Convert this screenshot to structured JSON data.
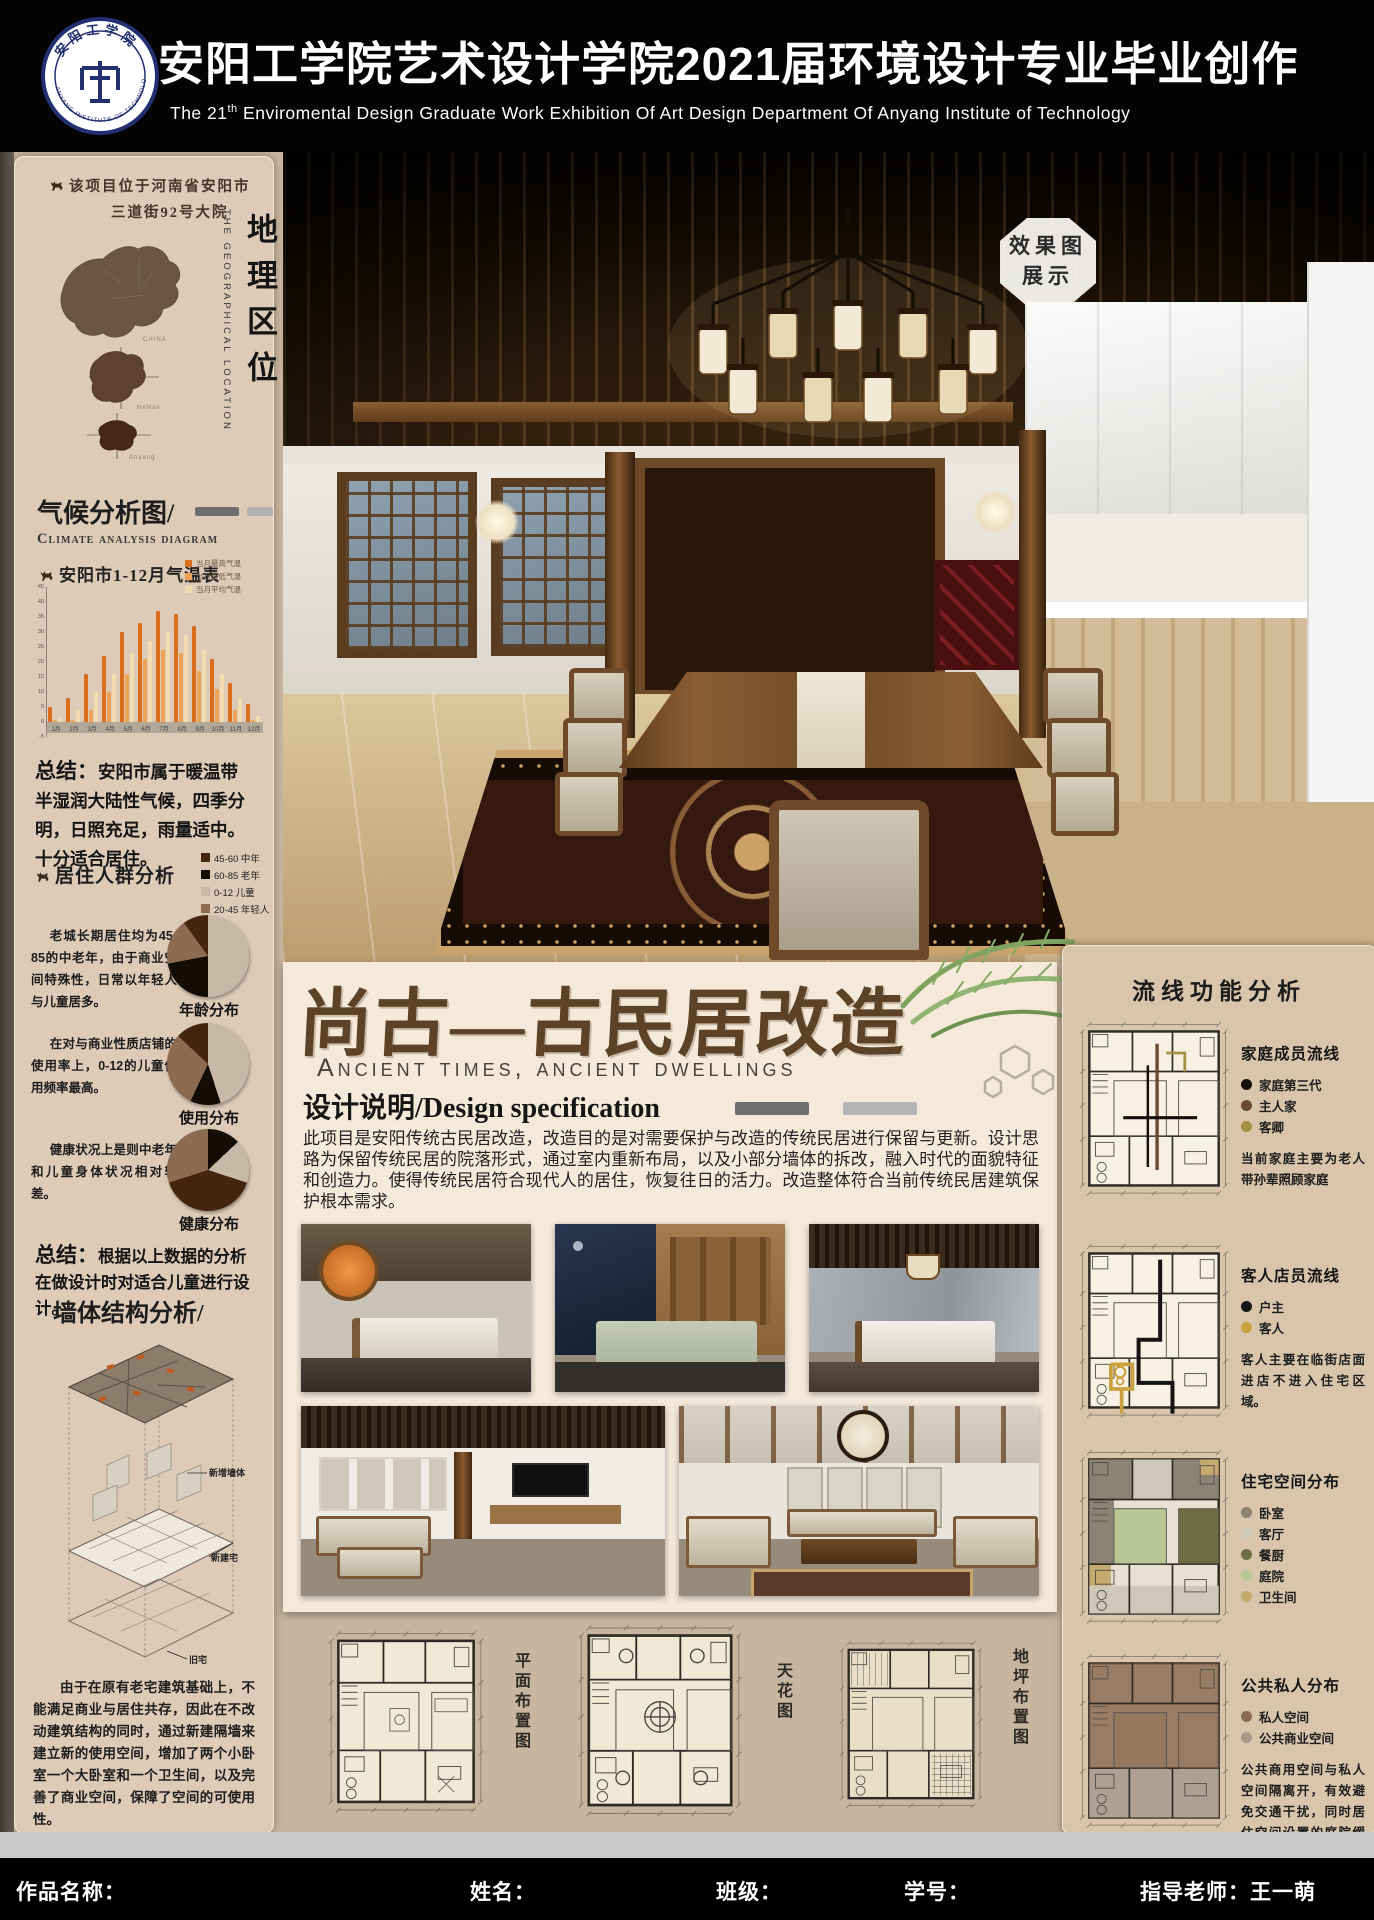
{
  "header": {
    "title": "安阳工学院艺术设计学院2021届环境设计专业毕业创作",
    "subtitle_prefix": "The 21",
    "subtitle_sup": "th",
    "subtitle_rest": " Enviromental  Design  Graduate Work Exhibition Of Art Design Department Of Anyang Institute of Technology",
    "logo": {
      "cn": "安阳工学院",
      "en": "ANYANG INSTITUTE OF TECHNOLOGY"
    }
  },
  "left": {
    "location": {
      "line1": "该项目位于河南省安阳市",
      "line2": "三道街92号大院",
      "title_cn": "地理区位",
      "title_en": "THE GEOGRAPHICAL LOCATION",
      "map_labels": [
        "CHINA",
        "HeNan",
        "Anyang"
      ]
    },
    "climate": {
      "heading": "气候分析图/",
      "heading_en": "Climate analysis diagram",
      "summary_label": "总结：",
      "summary": "安阳市属于暖温带半湿润大陆性气候，四季分明，日照充足，雨量适中。十分适合居住。"
    },
    "population": {
      "heading": "居住人群分析",
      "legend": [
        {
          "label": "45-60 中年",
          "color": "#44250f"
        },
        {
          "label": "60-85 老年",
          "color": "#140d06"
        },
        {
          "label": "0-12 儿童",
          "color": "#c8b9a7"
        },
        {
          "label": "20-45 年轻人",
          "color": "#8c6b53"
        }
      ],
      "pies": [
        {
          "text": "老城长期居住均为45-85的中老年，由于商业空间特殊性，日常以年轻人与儿童居多。"
        },
        {
          "text": "在对与商业性质店铺的使用率上，0-12的儿童使用频率最高。"
        },
        {
          "text": "健康状况上是则中老年和儿童身体状况相对较差。"
        }
      ],
      "summary_label": "总结：",
      "summary": "根据以上数据的分析在做设计时对适合儿童进行设计。"
    },
    "wall": {
      "heading": "墙体结构分析/",
      "labels": [
        "新增墙体",
        "新建宅",
        "旧宅"
      ],
      "text": "由于在原有老宅建筑基础上，不能满足商业与居住共存，因此在不改动建筑结构的同时，通过新建隔墙来建立新的使用空间，增加了两个小卧室一个大卧室和一个卫生间，以及完善了商业空间，保障了空间的可使用性。"
    }
  },
  "main": {
    "badge_line1": "效果图",
    "badge_line2": "展示",
    "title": "尚古—古民居改造",
    "subtitle": "Ancient times, ancient dwellings",
    "spec_heading": "设计说明/Design specification",
    "spec_text": "此项目是安阳传统古民居改造，改造目的是对需要保护与改造的传统民居进行保留与更新。设计思路为保留传统民居的院落形式，通过室内重新布局，以及小部分墙体的拆改，融入时代的面貌特征和创造力。使得传统民居符合现代人的居住，恢复往日的活力。改造整体符合当前传统民居建筑保护根本需求。"
  },
  "plans": {
    "labels": [
      "平面布置图",
      "天花图",
      "地坪布置图"
    ]
  },
  "right": {
    "heading": "流线功能分析",
    "sections": [
      {
        "title": "家庭成员流线",
        "variant": "flow-family",
        "legend": [
          {
            "label": "家庭第三代",
            "color": "#17100a"
          },
          {
            "label": "主人家",
            "color": "#6b4a35"
          },
          {
            "label": "客卿",
            "color": "#a39042"
          }
        ],
        "text": "当前家庭主要为老人带孙辈照顾家庭"
      },
      {
        "title": "客人店员流线",
        "variant": "flow-guest",
        "legend": [
          {
            "label": "户主",
            "color": "#141414"
          },
          {
            "label": "客人",
            "color": "#c9a23f"
          }
        ],
        "text": "客人主要在临街店面进店不进入住宅区域。"
      },
      {
        "title": "住宅空间分布",
        "variant": "zones",
        "legend": [
          {
            "label": "卧室",
            "color": "#8d8372"
          },
          {
            "label": "客厅",
            "color": "#cfc8b8"
          },
          {
            "label": "餐厨",
            "color": "#6d6d46"
          },
          {
            "label": "庭院",
            "color": "#b8c795"
          },
          {
            "label": "卫生间",
            "color": "#c4aa6e"
          }
        ],
        "text": ""
      },
      {
        "title": "公共私人分布",
        "variant": "public",
        "legend": [
          {
            "label": "私人空间",
            "color": "#8a6a52"
          },
          {
            "label": "公共商业空间",
            "color": "#a89888"
          }
        ],
        "text": "公共商用空间与私人空间隔离开，有效避免交通干扰，同时居住空间设置的庭院缓冲了外界的干扰。"
      }
    ]
  },
  "footer": {
    "items": [
      "作品名称：",
      "姓名：",
      "班级：",
      "学号：",
      "指导老师：王一萌"
    ]
  },
  "chart_data": [
    {
      "type": "bar",
      "title": "安阳市1-12月气温表",
      "categories": [
        "1月",
        "2月",
        "3月",
        "4月",
        "5月",
        "6月",
        "7月",
        "8月",
        "9月",
        "10月",
        "11月",
        "12月"
      ],
      "series": [
        {
          "name": "当月最高气温",
          "color": "#d96f1e",
          "values": [
            5,
            8,
            16,
            22,
            30,
            33,
            37,
            36,
            32,
            21,
            13,
            6
          ]
        },
        {
          "name": "当月最低气温",
          "color": "#eda355",
          "values": [
            -3,
            0,
            4,
            10,
            16,
            21,
            24,
            23,
            17,
            11,
            4,
            -1
          ]
        },
        {
          "name": "当月平均气温",
          "color": "#f2dcb0",
          "values": [
            1,
            4,
            10,
            16,
            23,
            27,
            30,
            29,
            24,
            16,
            8,
            2
          ]
        }
      ],
      "ylim": [
        -5,
        45
      ],
      "ytick_step": 5,
      "legend_position": "top-right",
      "xlabel": "",
      "ylabel": ""
    },
    {
      "type": "pie",
      "title": "年龄分布",
      "slices": [
        {
          "label": "0-12 儿童",
          "value": 50,
          "color": "#c8b9a7"
        },
        {
          "label": "60-85 老年",
          "value": 22,
          "color": "#140d06"
        },
        {
          "label": "20-45 年轻人",
          "value": 18,
          "color": "#8c6b53"
        },
        {
          "label": "45-60 中年",
          "value": 10,
          "color": "#44250f"
        }
      ]
    },
    {
      "type": "pie",
      "title": "使用分布",
      "slices": [
        {
          "label": "0-12 儿童",
          "value": 45,
          "color": "#c8b9a7"
        },
        {
          "label": "60-85 老年",
          "value": 12,
          "color": "#140d06"
        },
        {
          "label": "20-45 年轻人",
          "value": 30,
          "color": "#8c6b53"
        },
        {
          "label": "45-60 中年",
          "value": 13,
          "color": "#44250f"
        }
      ]
    },
    {
      "type": "pie",
      "title": "健康分布",
      "slices": [
        {
          "label": "60-85 老年",
          "value": 13,
          "color": "#140d06"
        },
        {
          "label": "0-12 儿童",
          "value": 17,
          "color": "#c8b9a7"
        },
        {
          "label": "45-60 中年",
          "value": 40,
          "color": "#44250f"
        },
        {
          "label": "20-45 年轻人",
          "value": 30,
          "color": "#8c6b53"
        }
      ]
    }
  ]
}
